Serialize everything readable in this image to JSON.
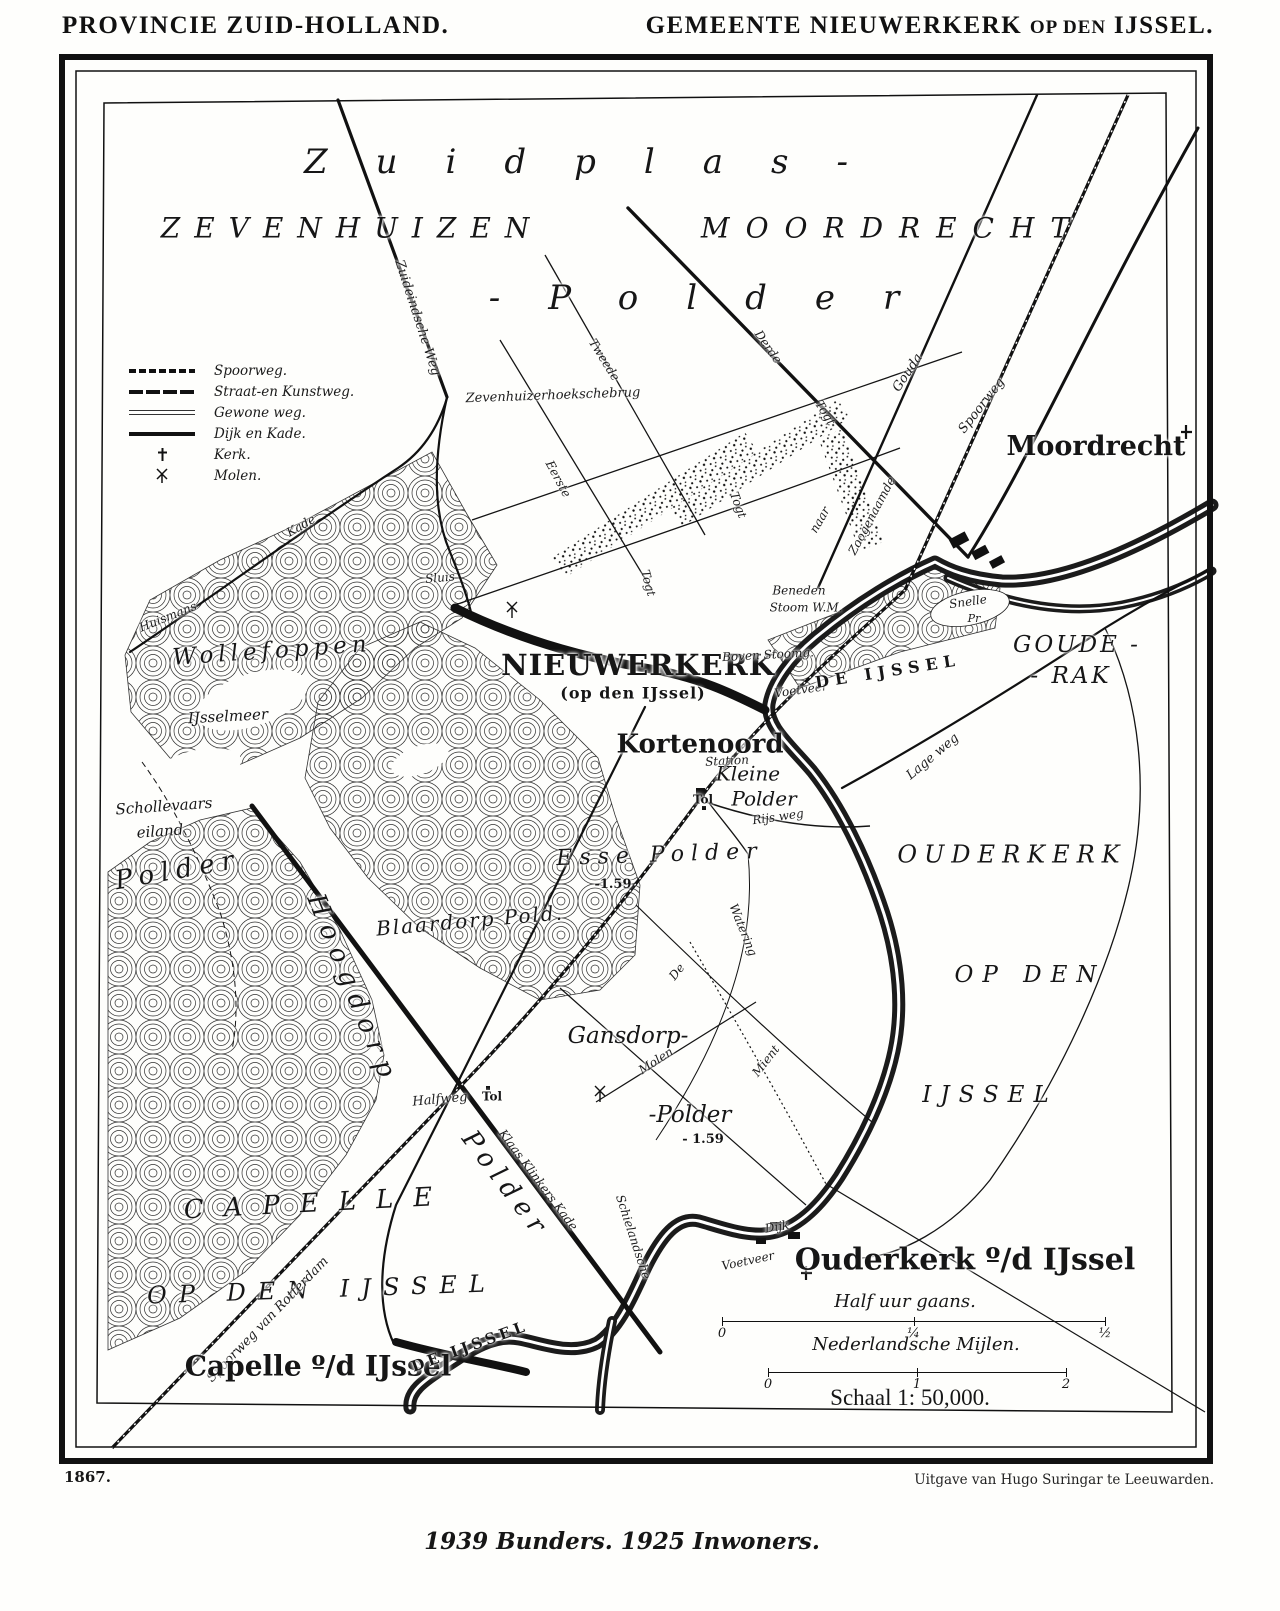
{
  "header": {
    "left": "PROVINCIE ZUID-HOLLAND.",
    "right_main1": "GEMEENTE NIEUWERKERK",
    "right_small": "OP DEN",
    "right_main2": "IJSSEL."
  },
  "legend": {
    "items": [
      {
        "label": "Spoorweg.",
        "type": "railway"
      },
      {
        "label": "Straat-en Kunstweg.",
        "type": "road-major"
      },
      {
        "label": "Gewone weg.",
        "type": "road-normal"
      },
      {
        "label": "Dijk en Kade.",
        "type": "dike"
      },
      {
        "label": "Kerk.",
        "type": "church"
      },
      {
        "label": "Molen.",
        "type": "mill"
      }
    ]
  },
  "scale": {
    "bar1_title": "Half uur gaans.",
    "bar1_ticks": [
      "0",
      "¼",
      "½"
    ],
    "bar2_title": "Nederlandsche Mijlen.",
    "bar2_ticks": [
      "0",
      "1",
      "2"
    ],
    "schaal": "Schaal 1: 50,000."
  },
  "footer": {
    "year": "1867.",
    "publisher": "Uitgave van Hugo Suringar te Leeuwarden.",
    "stats": "1939 Bunders. 1925 Inwoners."
  },
  "map_labels": [
    {
      "t": "Zuidplas-",
      "x": 600,
      "y": 163,
      "r": 0,
      "c": "giant",
      "s": 34,
      "ls": 48
    },
    {
      "t": "ZEVENHUIZEN",
      "x": 352,
      "y": 228,
      "r": 0,
      "c": "region",
      "s": 28,
      "ls": 14
    },
    {
      "t": "MOORDRECHT",
      "x": 893,
      "y": 228,
      "r": 0,
      "c": "region",
      "s": 28,
      "ls": 16
    },
    {
      "t": "-Polder",
      "x": 718,
      "y": 299,
      "r": 0,
      "c": "giant",
      "s": 34,
      "ls": 48
    },
    {
      "t": "Zuideindsche Weg",
      "x": 417,
      "y": 318,
      "r": 72,
      "c": "small",
      "s": 13
    },
    {
      "t": "Zevenhuizerhoekschebrug",
      "x": 553,
      "y": 396,
      "r": -2,
      "c": "small",
      "s": 13
    },
    {
      "t": "Eerste",
      "x": 558,
      "y": 479,
      "r": 62,
      "c": "small",
      "s": 12
    },
    {
      "t": "Togt",
      "x": 648,
      "y": 583,
      "r": 75,
      "c": "small",
      "s": 12
    },
    {
      "t": "Tweede",
      "x": 604,
      "y": 360,
      "r": 58,
      "c": "small",
      "s": 12
    },
    {
      "t": "Togt",
      "x": 738,
      "y": 505,
      "r": 70,
      "c": "small",
      "s": 12
    },
    {
      "t": "Derde",
      "x": 768,
      "y": 347,
      "r": 55,
      "c": "small",
      "s": 12
    },
    {
      "t": "Togt",
      "x": 825,
      "y": 413,
      "r": 58,
      "c": "small",
      "s": 12
    },
    {
      "t": "naar",
      "x": 820,
      "y": 520,
      "r": -60,
      "c": "small",
      "s": 12
    },
    {
      "t": "Zoogenaamde",
      "x": 872,
      "y": 516,
      "r": -62,
      "c": "small",
      "s": 12
    },
    {
      "t": "Gouda",
      "x": 908,
      "y": 373,
      "r": -56,
      "c": "small",
      "s": 13
    },
    {
      "t": "Spoorweg",
      "x": 982,
      "y": 406,
      "r": -52,
      "c": "small",
      "s": 13
    },
    {
      "t": "Moordrecht",
      "x": 1096,
      "y": 447,
      "r": 0,
      "c": "town",
      "s": 27
    },
    {
      "t": "Sluis",
      "x": 440,
      "y": 578,
      "r": -5,
      "c": "small",
      "s": 12
    },
    {
      "t": "Kade",
      "x": 301,
      "y": 526,
      "r": -30,
      "c": "small",
      "s": 12
    },
    {
      "t": "Huismans",
      "x": 168,
      "y": 617,
      "r": -22,
      "c": "small",
      "s": 12
    },
    {
      "t": "Wollefoppen",
      "x": 272,
      "y": 651,
      "r": -4,
      "c": "script",
      "s": 23,
      "ls": 5
    },
    {
      "t": "IJsselmeer",
      "x": 228,
      "y": 717,
      "r": -3,
      "c": "script",
      "s": 15
    },
    {
      "t": "Schollevaars",
      "x": 164,
      "y": 807,
      "r": -4,
      "c": "script",
      "s": 15
    },
    {
      "t": "eiland",
      "x": 160,
      "y": 832,
      "r": -4,
      "c": "script",
      "s": 15
    },
    {
      "t": "Polder",
      "x": 178,
      "y": 871,
      "r": -10,
      "c": "script",
      "s": 26,
      "ls": 7
    },
    {
      "t": "NIEUWERKERK",
      "x": 638,
      "y": 665,
      "r": 0,
      "c": "townbold",
      "s": 29,
      "ls": 1
    },
    {
      "t": "(op den IJssel)",
      "x": 633,
      "y": 694,
      "r": 0,
      "c": "townbold",
      "s": 16
    },
    {
      "t": "Kortenoord",
      "x": 700,
      "y": 745,
      "r": 0,
      "c": "town",
      "s": 26
    },
    {
      "t": "Beneden",
      "x": 799,
      "y": 591,
      "r": 0,
      "c": "small",
      "s": 12
    },
    {
      "t": "Stoom W.M.",
      "x": 806,
      "y": 608,
      "r": 0,
      "c": "small",
      "s": 12
    },
    {
      "t": "Boven Stoomg.",
      "x": 768,
      "y": 655,
      "r": -3,
      "c": "small",
      "s": 12
    },
    {
      "t": "Voetveer",
      "x": 801,
      "y": 690,
      "r": -8,
      "c": "small",
      "s": 12
    },
    {
      "t": "DE IJSSEL",
      "x": 888,
      "y": 672,
      "r": -9,
      "c": "river",
      "s": 16,
      "ls": 6
    },
    {
      "t": "Snelle",
      "x": 968,
      "y": 602,
      "r": -8,
      "c": "small",
      "s": 12
    },
    {
      "t": "Pr",
      "x": 974,
      "y": 619,
      "r": 0,
      "c": "small",
      "s": 11
    },
    {
      "t": "GOUDE -",
      "x": 1077,
      "y": 645,
      "r": 0,
      "c": "region",
      "s": 23,
      "ls": 3
    },
    {
      "t": "- RAK",
      "x": 1071,
      "y": 676,
      "r": 0,
      "c": "region",
      "s": 23,
      "ls": 3
    },
    {
      "t": "Lage weg",
      "x": 933,
      "y": 757,
      "r": -40,
      "c": "small",
      "s": 13
    },
    {
      "t": "OUDERKERK",
      "x": 1012,
      "y": 855,
      "r": 0,
      "c": "region",
      "s": 24,
      "ls": 7
    },
    {
      "t": "OP DEN",
      "x": 1030,
      "y": 975,
      "r": 0,
      "c": "region",
      "s": 23,
      "ls": 9
    },
    {
      "t": "IJSSEL",
      "x": 990,
      "y": 1095,
      "r": 0,
      "c": "region",
      "s": 23,
      "ls": 9
    },
    {
      "t": "Station",
      "x": 727,
      "y": 761,
      "r": -3,
      "c": "small",
      "s": 12
    },
    {
      "t": "Tol",
      "x": 703,
      "y": 800,
      "r": 0,
      "c": "smallb",
      "s": 12
    },
    {
      "t": "Kleine",
      "x": 748,
      "y": 774,
      "r": 0,
      "c": "script",
      "s": 20
    },
    {
      "t": "Polder",
      "x": 764,
      "y": 799,
      "r": 0,
      "c": "script",
      "s": 20
    },
    {
      "t": "Rijs weg",
      "x": 778,
      "y": 817,
      "r": -8,
      "c": "small",
      "s": 12
    },
    {
      "t": "Watering",
      "x": 743,
      "y": 930,
      "r": 68,
      "c": "small",
      "s": 12
    },
    {
      "t": "Esse Polder",
      "x": 660,
      "y": 855,
      "r": -2,
      "c": "script",
      "s": 22,
      "ls": 7
    },
    {
      "t": "-1.59",
      "x": 613,
      "y": 885,
      "r": 0,
      "c": "smallb",
      "s": 13
    },
    {
      "t": "Blaardorp Pold.",
      "x": 470,
      "y": 921,
      "r": -5,
      "c": "script",
      "s": 20,
      "ls": 2
    },
    {
      "t": "Hoogdorp",
      "x": 352,
      "y": 990,
      "r": 68,
      "c": "script",
      "s": 26,
      "ls": 9
    },
    {
      "t": "Gansdorp-",
      "x": 628,
      "y": 1036,
      "r": 0,
      "c": "script",
      "s": 23
    },
    {
      "t": "Molen",
      "x": 656,
      "y": 1061,
      "r": -33,
      "c": "small",
      "s": 12
    },
    {
      "t": "Mient",
      "x": 766,
      "y": 1061,
      "r": -52,
      "c": "small",
      "s": 12
    },
    {
      "t": "De",
      "x": 677,
      "y": 972,
      "r": -52,
      "c": "small",
      "s": 12
    },
    {
      "t": "-Polder",
      "x": 690,
      "y": 1115,
      "r": 0,
      "c": "script",
      "s": 23
    },
    {
      "t": "- 1.59",
      "x": 703,
      "y": 1140,
      "r": 0,
      "c": "smallb",
      "s": 13
    },
    {
      "t": "Halfweg",
      "x": 440,
      "y": 1100,
      "r": -5,
      "c": "small",
      "s": 13
    },
    {
      "t": "Tol",
      "x": 492,
      "y": 1097,
      "r": 0,
      "c": "smallb",
      "s": 12
    },
    {
      "t": "Klaas Klinkers Kade",
      "x": 538,
      "y": 1180,
      "r": 53,
      "c": "small",
      "s": 12
    },
    {
      "t": "Polder",
      "x": 505,
      "y": 1185,
      "r": 53,
      "c": "script",
      "s": 26,
      "ls": 7
    },
    {
      "t": "Schielandsche",
      "x": 633,
      "y": 1237,
      "r": 72,
      "c": "small",
      "s": 12
    },
    {
      "t": "CAPELLE",
      "x": 318,
      "y": 1204,
      "r": -3,
      "c": "region",
      "s": 26,
      "ls": 20
    },
    {
      "t": "OP DEN IJSSEL",
      "x": 322,
      "y": 1290,
      "r": -2,
      "c": "region",
      "s": 24,
      "ls": 12
    },
    {
      "t": "Spoorweg van Rotterdam",
      "x": 268,
      "y": 1320,
      "r": -46,
      "c": "small",
      "s": 13
    },
    {
      "t": "Capelle º/d IJssel",
      "x": 318,
      "y": 1366,
      "r": 0,
      "c": "town",
      "s": 28
    },
    {
      "t": "DE IJSSEL",
      "x": 470,
      "y": 1347,
      "r": -20,
      "c": "river",
      "s": 15,
      "ls": 4
    },
    {
      "t": "Dijk",
      "x": 777,
      "y": 1227,
      "r": -10,
      "c": "small",
      "s": 12
    },
    {
      "t": "Voetveer",
      "x": 748,
      "y": 1261,
      "r": -12,
      "c": "small",
      "s": 12
    },
    {
      "t": "Ouderkerk º/d IJssel",
      "x": 965,
      "y": 1260,
      "r": 0,
      "c": "town",
      "s": 30
    }
  ]
}
